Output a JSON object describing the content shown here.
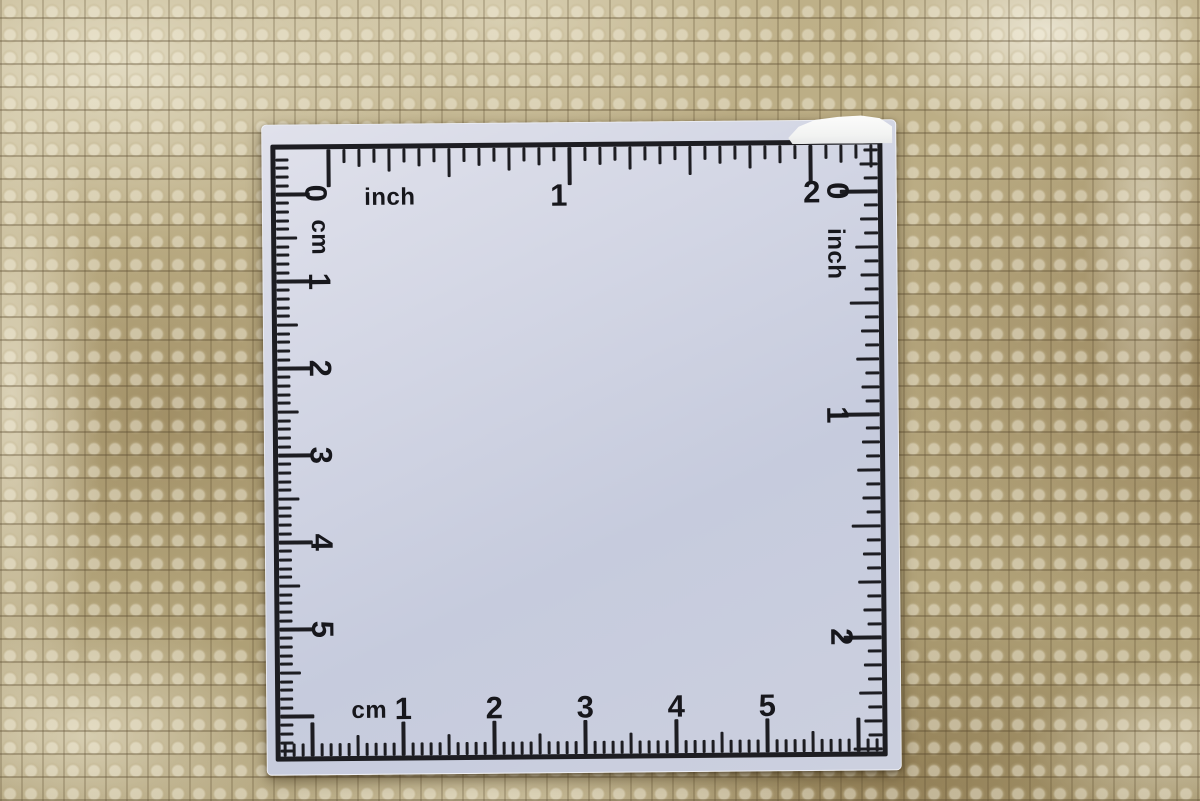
{
  "scene": {
    "description": "white square photographic scale card with inch and cm rulers lying on a beige woven carpet"
  },
  "ruler": {
    "zero_top_left": "0",
    "zero_top_right": "0",
    "top": {
      "unit": "inch",
      "labels": [
        "1",
        "2"
      ],
      "divisions_per_unit": 16
    },
    "right": {
      "unit": "inch",
      "labels": [
        "1",
        "2"
      ],
      "divisions_per_unit": 16
    },
    "left": {
      "unit": "cm",
      "labels": [
        "1",
        "2",
        "3",
        "4",
        "5"
      ],
      "divisions_per_unit": 10
    },
    "bottom": {
      "unit": "cm",
      "labels": [
        "1",
        "2",
        "3",
        "4",
        "5"
      ],
      "divisions_per_unit": 10
    }
  },
  "colors": {
    "card_surface": "#ccd1e1",
    "print_black": "#1d1d22",
    "carpet_base": "#b2a37c",
    "carpet_cream": "#e7e0c8",
    "carpet_dark": "#8a7a58",
    "corner_chip_white": "#f7f7f5"
  }
}
